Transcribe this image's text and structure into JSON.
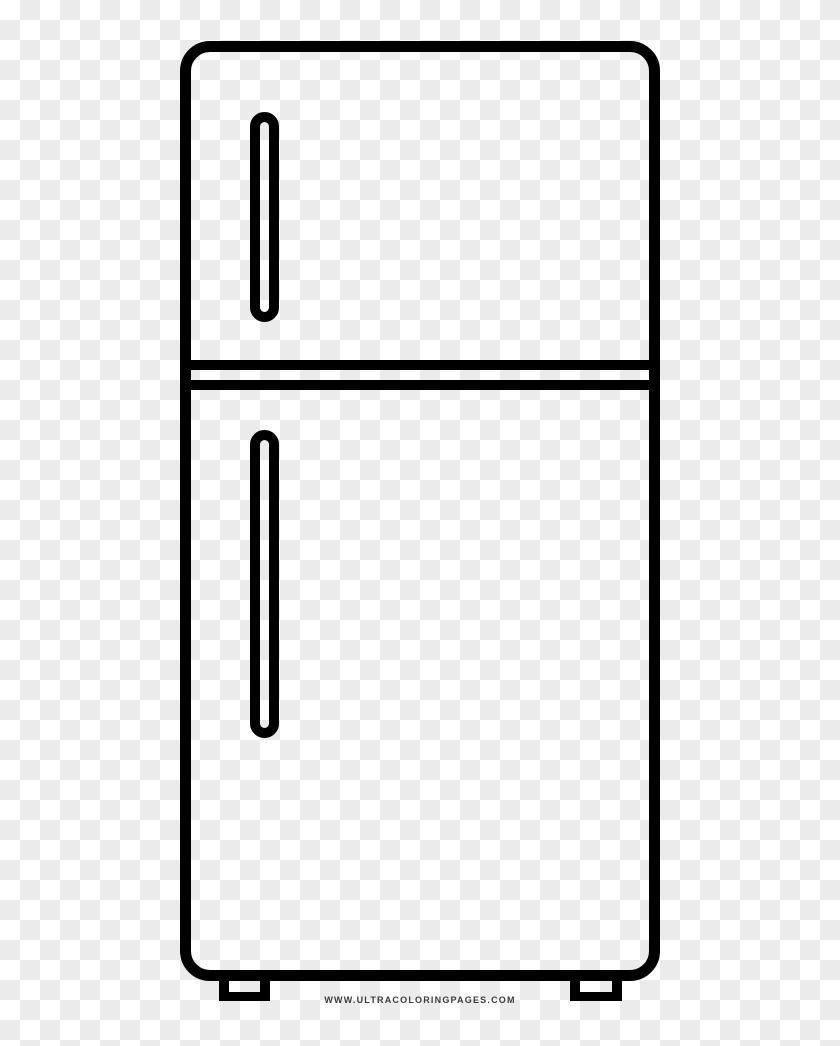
{
  "page": {
    "type": "coloring-page-image",
    "subject": "refrigerator",
    "description": "black outline drawing of a top-freezer refrigerator with two vertical pill handles, a double divider line between doors, and two small feet, on a transparent checkerboard background"
  },
  "colors": {
    "line": "#000000",
    "checker_white": "#ffffff",
    "checker_gray": "#ebebeb",
    "watermark_text": "#3b3b3b"
  },
  "background": {
    "style": "transparency-checkerboard",
    "cell_size_px": 20
  },
  "watermark": {
    "text": "WWW.ULTRACOLORINGPAGES.COM"
  }
}
